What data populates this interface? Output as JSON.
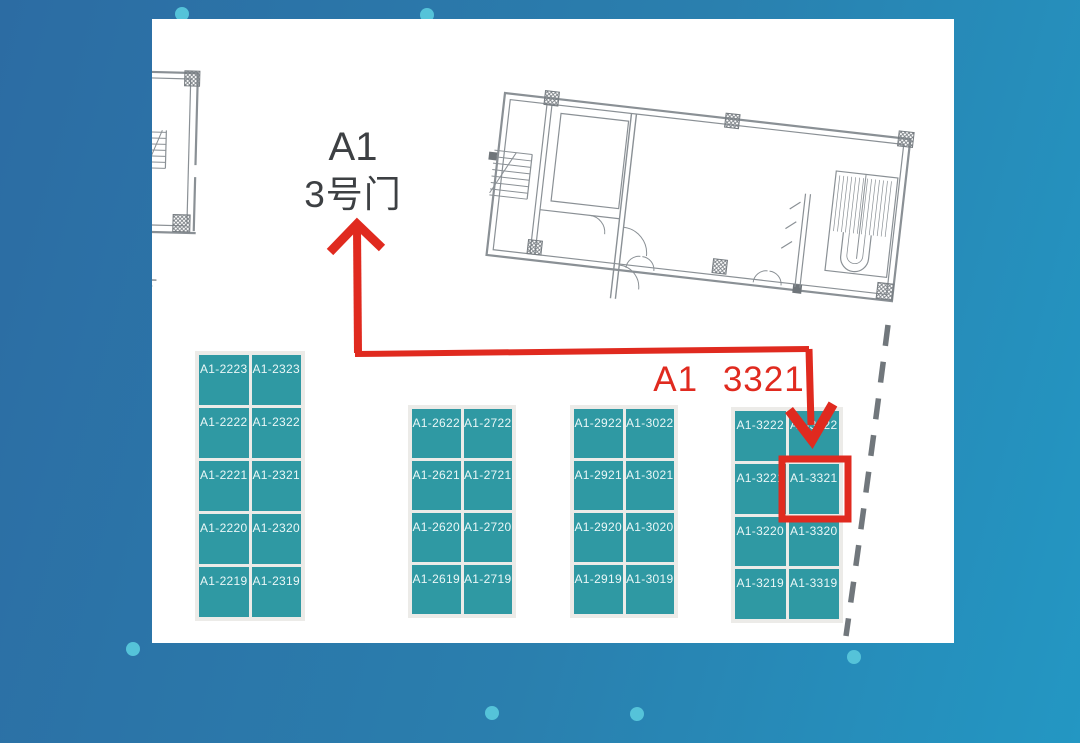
{
  "labels": {
    "gate_line1": "A1",
    "gate_line2": "3号门",
    "target": "A1 3321"
  },
  "highlight": {
    "booth_id": "A1-3321"
  },
  "booth_groups": [
    {
      "id": "booth-block-2200-2300",
      "rows": [
        [
          "A1-2223",
          "A1-2323"
        ],
        [
          "A1-2222",
          "A1-2322"
        ],
        [
          "A1-2221",
          "A1-2321"
        ],
        [
          "A1-2220",
          "A1-2320"
        ],
        [
          "A1-2219",
          "A1-2319"
        ]
      ]
    },
    {
      "id": "booth-block-2600-2700",
      "rows": [
        [
          "A1-2622",
          "A1-2722"
        ],
        [
          "A1-2621",
          "A1-2721"
        ],
        [
          "A1-2620",
          "A1-2720"
        ],
        [
          "A1-2619",
          "A1-2719"
        ]
      ]
    },
    {
      "id": "booth-block-2900-3000",
      "rows": [
        [
          "A1-2922",
          "A1-3022"
        ],
        [
          "A1-2921",
          "A1-3021"
        ],
        [
          "A1-2920",
          "A1-3020"
        ],
        [
          "A1-2919",
          "A1-3019"
        ]
      ]
    },
    {
      "id": "booth-block-3200-3300",
      "rows": [
        [
          "A1-3222",
          "A1-3322"
        ],
        [
          "A1-3221",
          "A1-3321"
        ],
        [
          "A1-3220",
          "A1-3320"
        ],
        [
          "A1-3219",
          "A1-3319"
        ]
      ]
    }
  ],
  "colors": {
    "background_start": "#2c6ca3",
    "background_end": "#2397c3",
    "panel": "#ffffff",
    "group_bg": "#ecebe8",
    "booth": "#2f99a3",
    "booth_text": "#eaf7f7",
    "red": "#e02a1f",
    "dark_text": "#3d4043",
    "plan_line": "#8a9095",
    "dot": "#55c3d9"
  }
}
